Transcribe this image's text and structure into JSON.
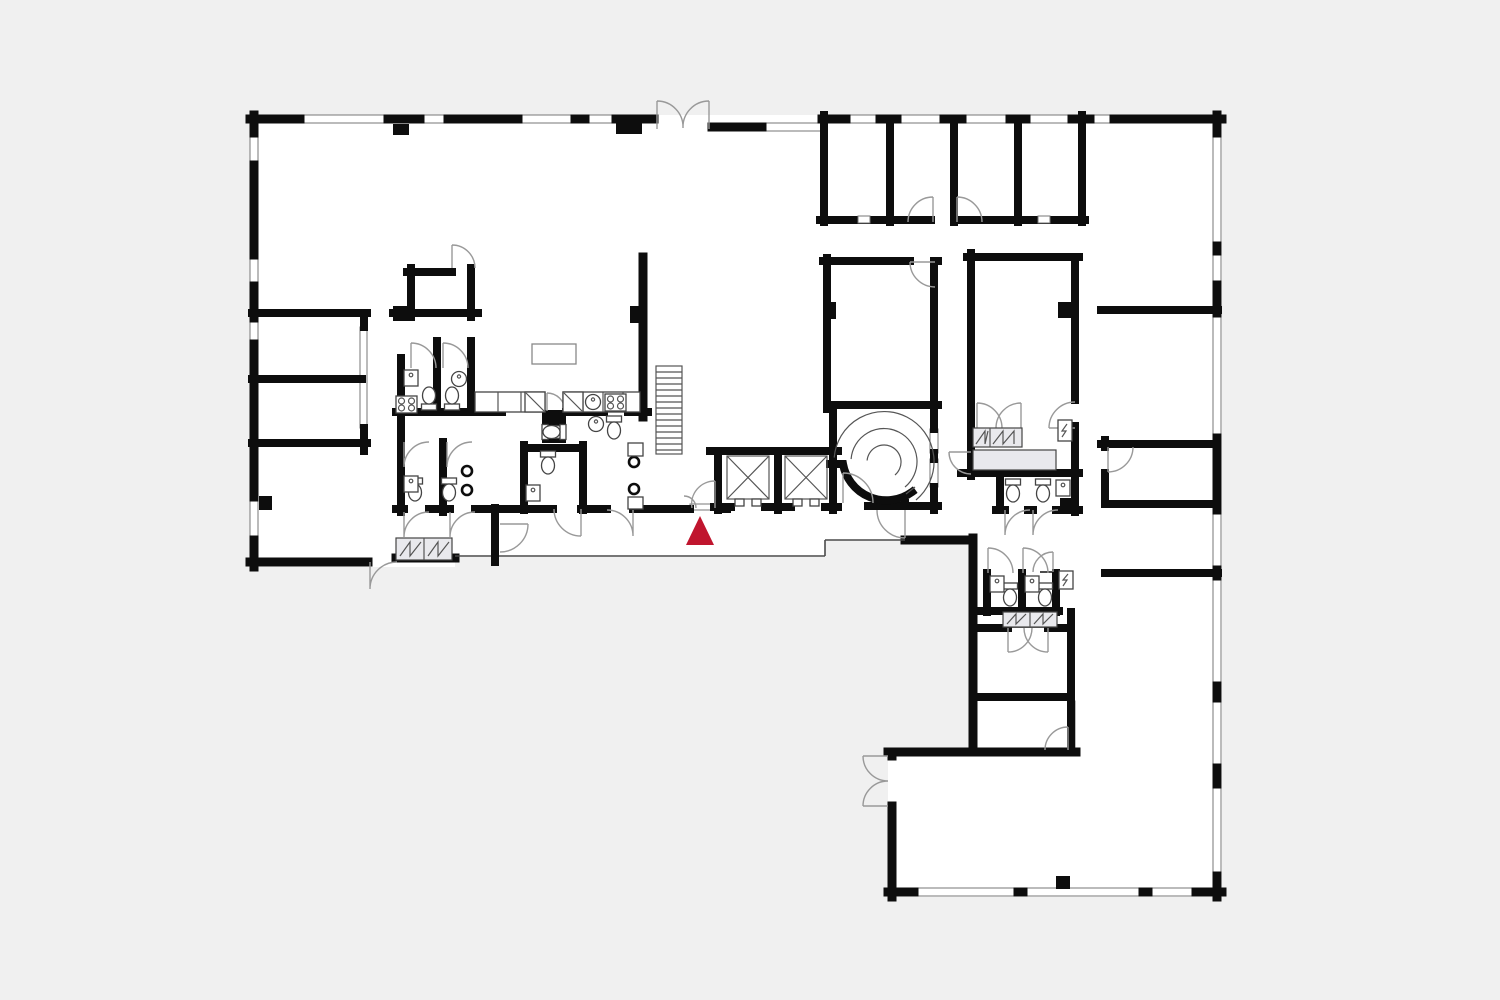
{
  "page": {
    "type": "architectural-floor-plan",
    "background_color": "#f0f0f0"
  },
  "plan": {
    "floor_color": "#ffffff",
    "wall_color": "#0d0d0d",
    "door_arc_color": "#999999",
    "window_line_color": "#777777",
    "furniture_fill_color": "#e9e9ed",
    "features": {
      "elevators": 2,
      "straight_stair": 1,
      "curved_stair": 1,
      "restroom_core": true,
      "main_entrance_double_door_top": true,
      "secondary_entrance_bottom_left": true,
      "secondary_entrance_bottom_right_wing": true
    }
  },
  "marker": {
    "name": "you-are-here-marker",
    "shape": "triangle-up",
    "color": "#c0152e",
    "apex_x": 700,
    "apex_y": 516,
    "base_y": 545,
    "half_width": 14
  }
}
